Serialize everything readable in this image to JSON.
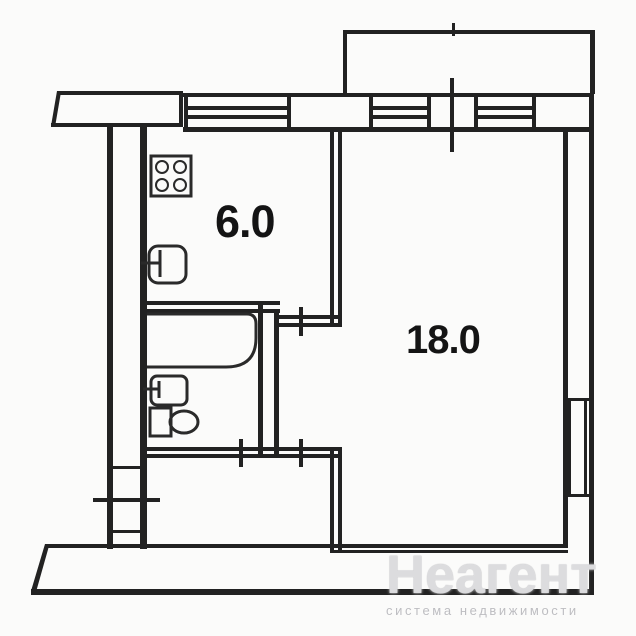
{
  "document": {
    "type": "apartment-floor-plan-scan",
    "background_color": "#fbfbfa",
    "line_color": "#222222"
  },
  "rooms": {
    "kitchen": {
      "area_label": "6.0"
    },
    "living_room": {
      "area_label": "18.0"
    }
  },
  "fixtures": {
    "stove": "stove-icon",
    "kitchen_sink": "sink-icon",
    "bathtub": "bathtub-icon",
    "wash_basin": "wash-basin-icon",
    "toilet": "toilet-icon"
  },
  "openings": {
    "entrance_door": "tick-mark-left-wall",
    "bathroom_door": "tick-mark",
    "kitchen_door": "tick-mark",
    "hall_passage_door": "tick-mark",
    "balcony_door": "tick-mark-top-band"
  },
  "watermark": {
    "title": "Неагент",
    "subtitle": "система недвижимости"
  }
}
